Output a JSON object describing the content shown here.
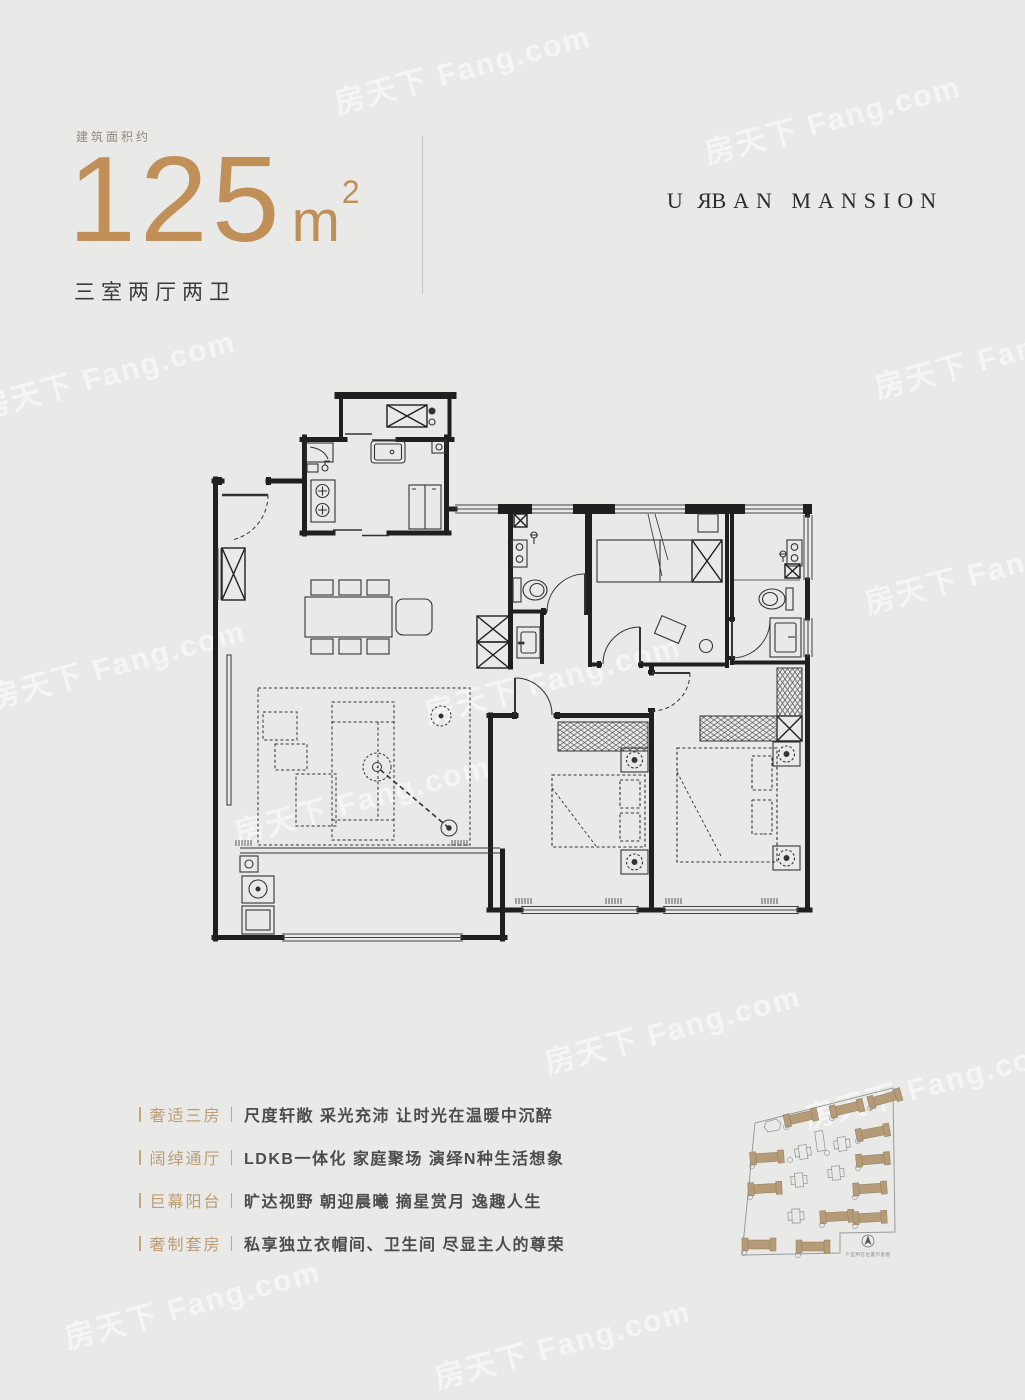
{
  "colors": {
    "gold": "#c18f58",
    "feature_label_gold": "#bd9d75",
    "text_dark": "#3b3b3b",
    "background": "#e9e9e8",
    "plan_line": "#1f1f1f",
    "site_building_tan": "#b59b77"
  },
  "header": {
    "area_label": "建筑面积约",
    "area_number": "125",
    "area_unit": "m",
    "area_exponent": "2",
    "layout": "三室两厅两卫",
    "brand": {
      "pre": "U",
      "mirrored_letter": "R",
      "rest": "BAN MANSION"
    }
  },
  "features": [
    {
      "label": "奢适三房",
      "desc": "尺度轩敞  采光充沛  让时光在温暖中沉醉"
    },
    {
      "label": "阔绰通厅",
      "desc": "LDKB一体化  家庭聚场  演绎N种生活想象"
    },
    {
      "label": "巨幕阳台",
      "desc": "旷达视野  朝迎晨曦  摘星赏月  逸趣人生"
    },
    {
      "label": "奢制套房",
      "desc": "私享独立衣帽间、卫生间  尽显主人的尊荣"
    }
  ],
  "site_plan": {
    "caption": "户型所在位置示意图"
  },
  "watermark": {
    "text": "房天下 Fang.com"
  }
}
